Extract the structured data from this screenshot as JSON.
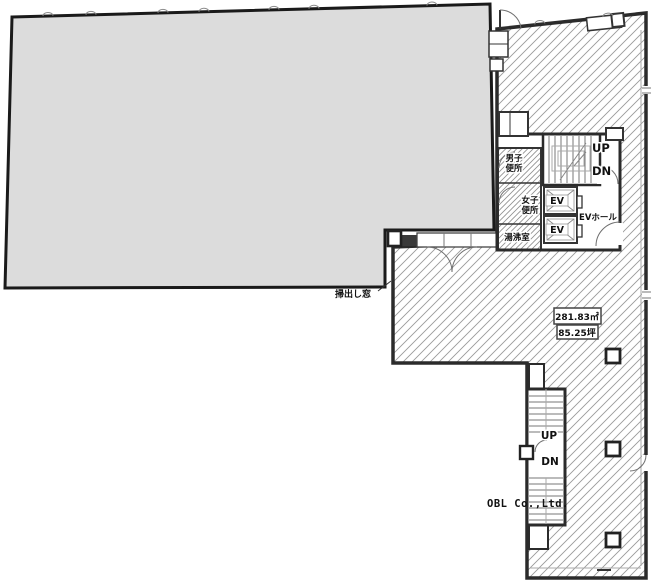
{
  "plan": {
    "stair_main": {
      "up": "UP",
      "dn": "DN"
    },
    "stair_sub": {
      "up": "UP",
      "dn": "DN"
    },
    "elevator_1": "EV",
    "elevator_2": "EV",
    "ev_hall": "EVホール",
    "mens_toilet": {
      "line1": "男子",
      "line2": "便所"
    },
    "womens_toilet": {
      "line1": "女子",
      "line2": "便所"
    },
    "kitchenette": "湯沸室",
    "sweep_out_window": "掃出し窓",
    "area": {
      "square_meters": "281.83㎡",
      "tsubo": "85.25坪"
    },
    "watermark": "OBL Co.,Ltd."
  },
  "colors": {
    "tenant_fill": "#dcdcdc",
    "wall": "#2b2b2b",
    "hatch_line": "#9a9a9a",
    "text": "#111111"
  }
}
